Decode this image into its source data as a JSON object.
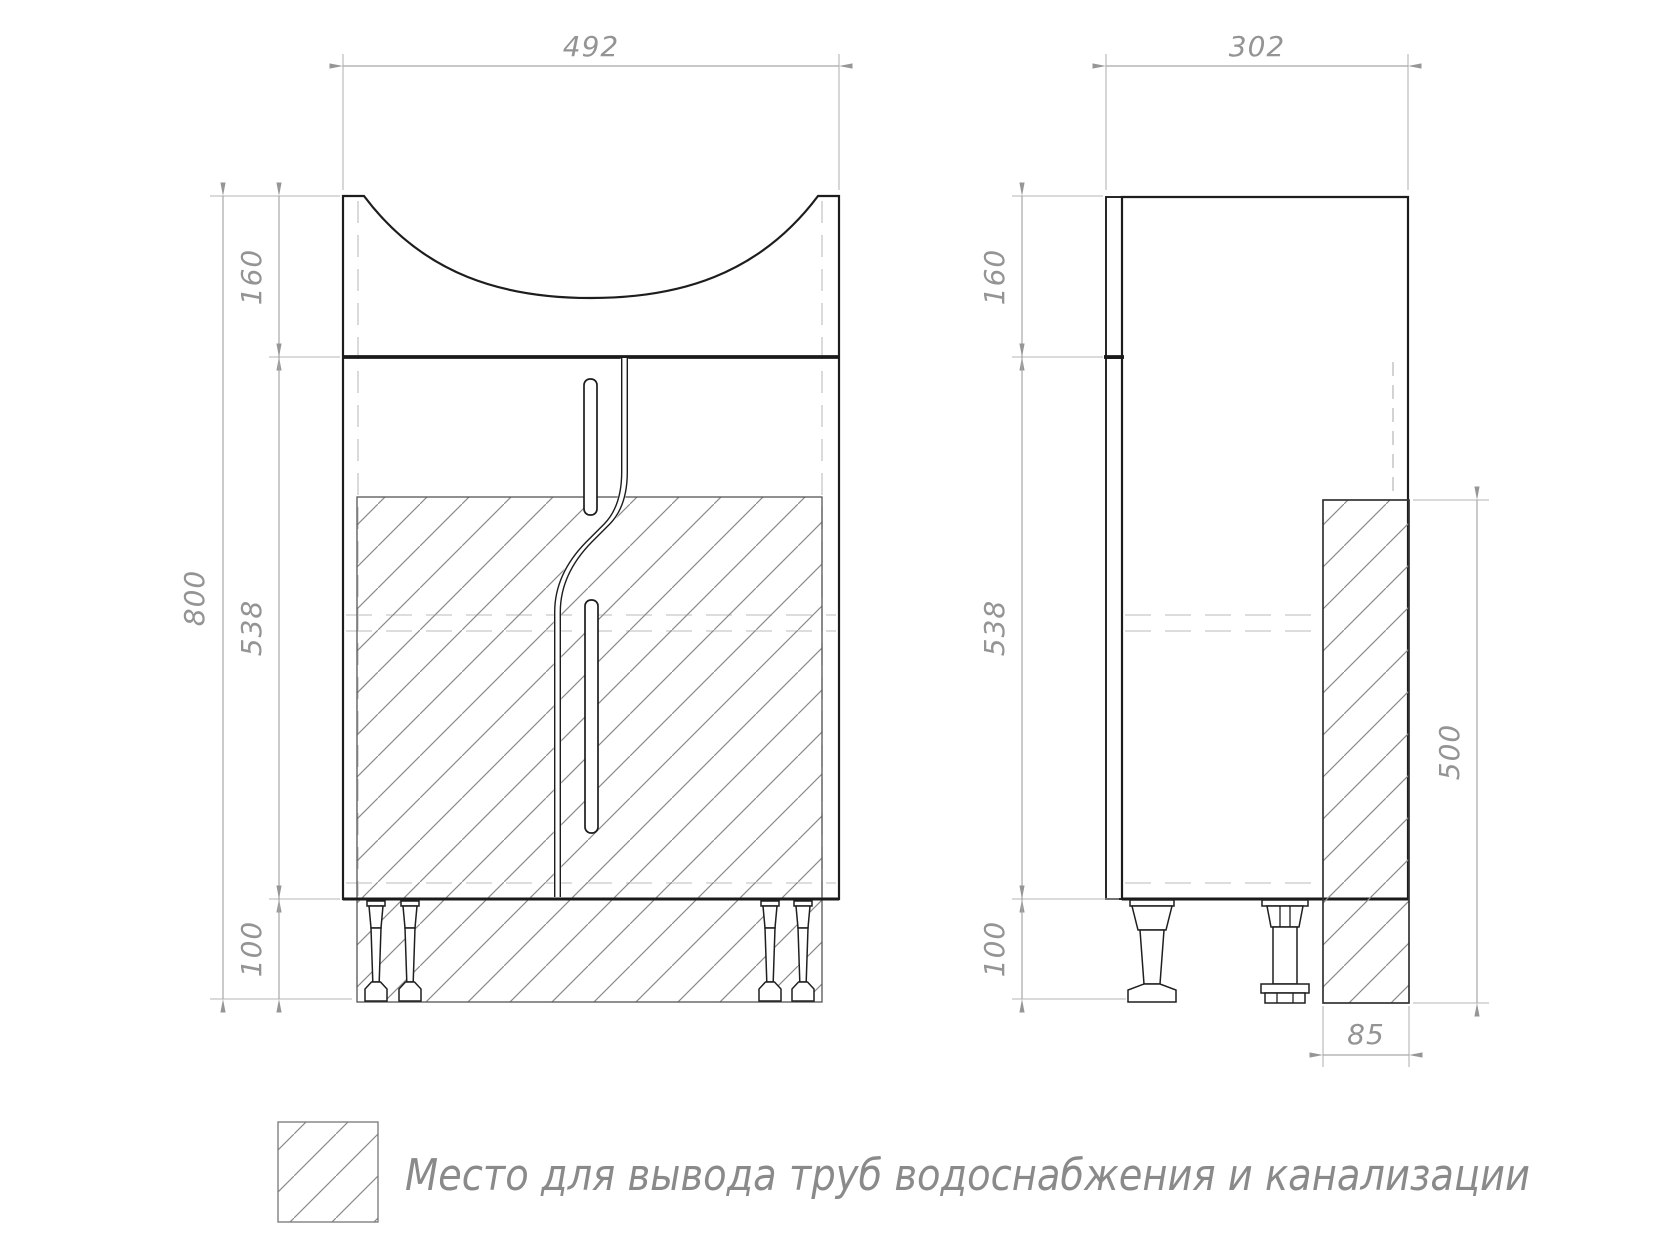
{
  "drawing_type": "furniture technical drawing (vanity cabinet with sink, front and side views)",
  "front_view": {
    "width_mm": "492",
    "basin_height_mm": "160",
    "total_height_mm": "800",
    "body_height_mm": "538",
    "legs_height_mm": "100"
  },
  "side_view": {
    "depth_mm": "302",
    "basin_height_mm": "160",
    "body_height_mm": "538",
    "legs_height_mm": "100",
    "pipe_zone_height_mm": "500",
    "pipe_zone_depth_mm": "85"
  },
  "legend": {
    "label": "Место для вывода труб водоснабжения и канализации"
  },
  "colors": {
    "outline": "#1d1d1d",
    "dimension": "#949494",
    "hatch": "#8a8a8a",
    "hidden_line": "#cfcfcf",
    "background": "#ffffff"
  }
}
